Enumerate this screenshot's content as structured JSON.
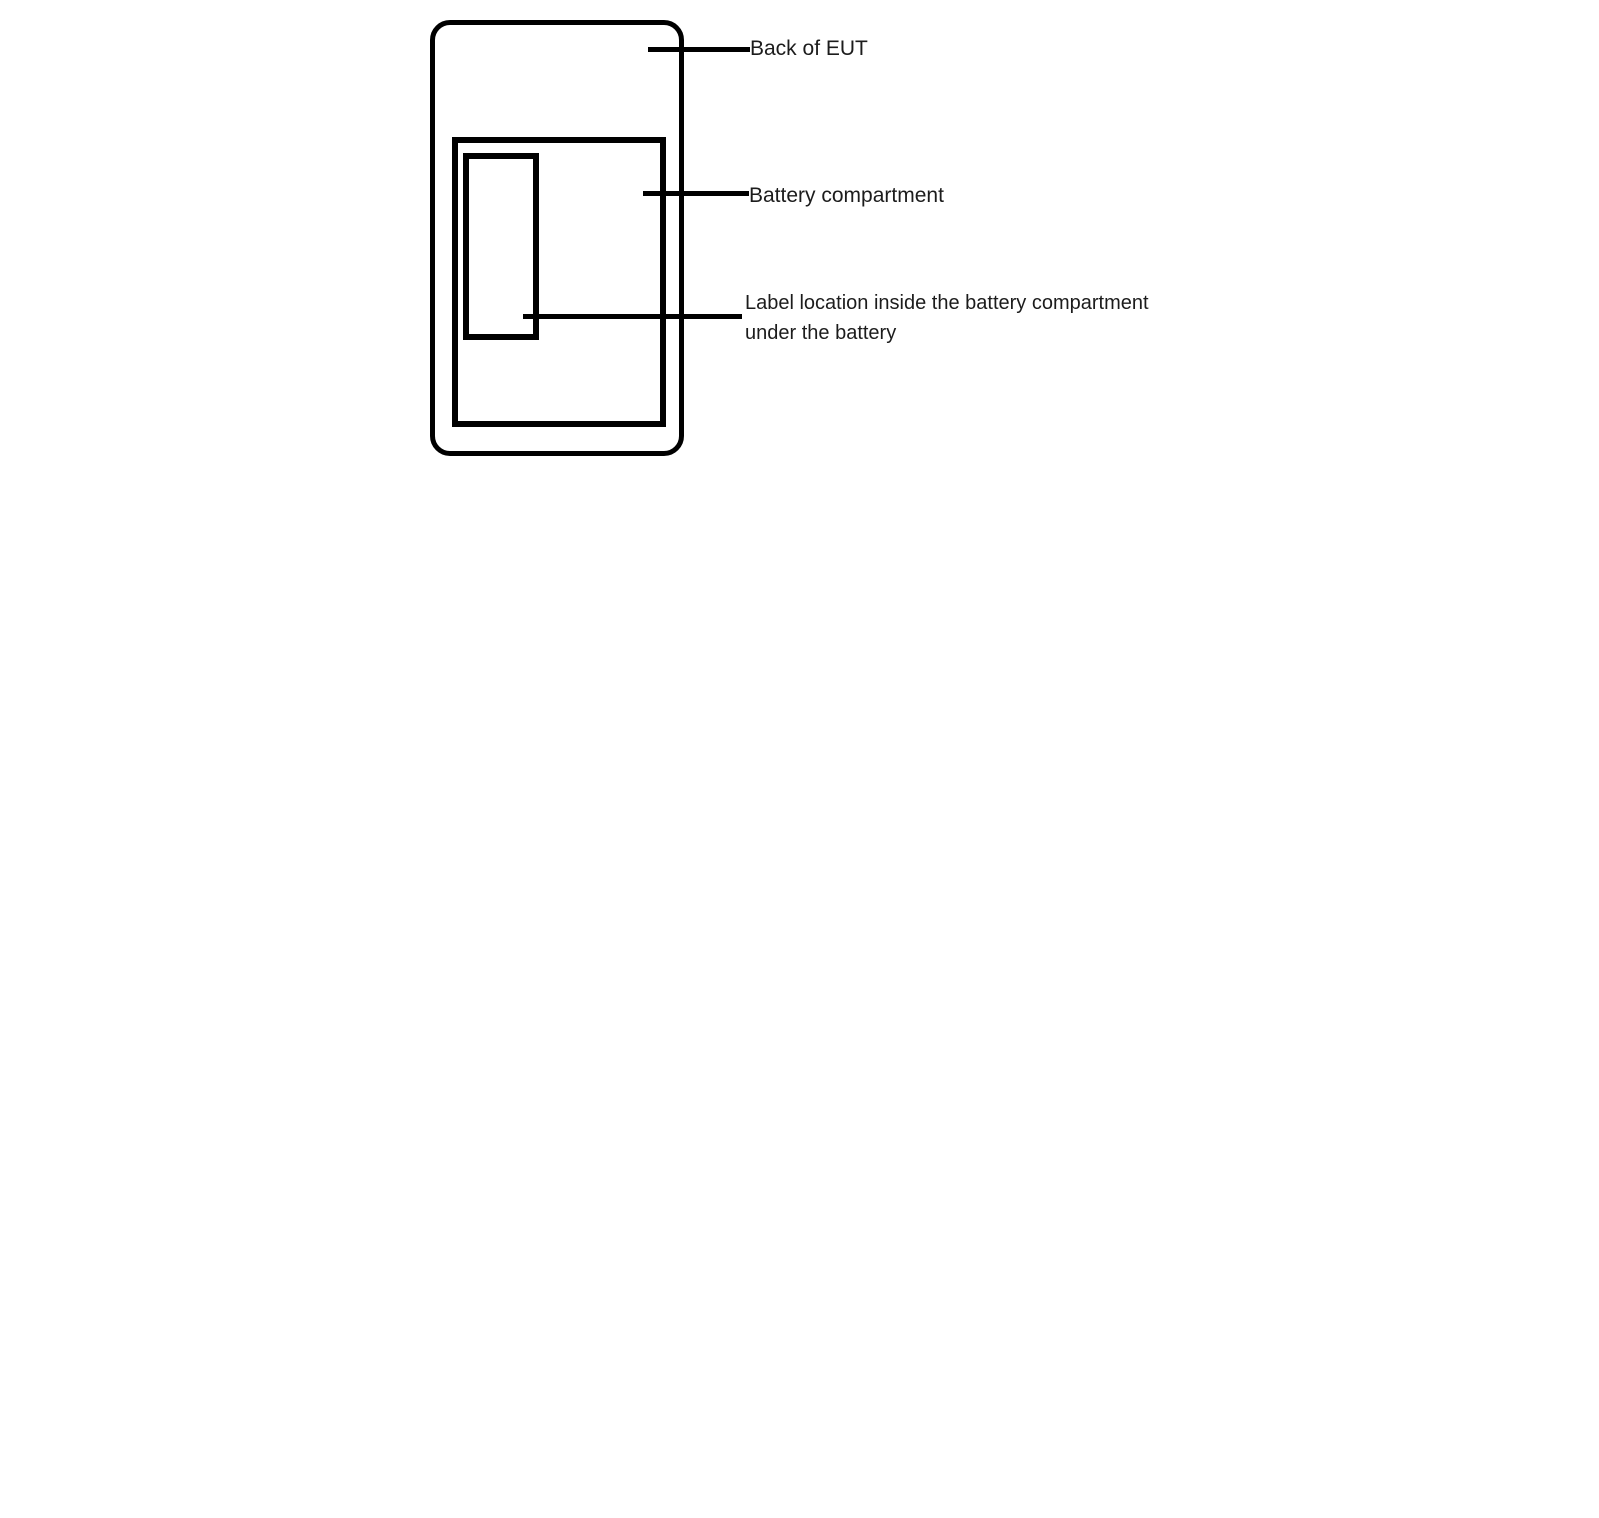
{
  "figure": {
    "description": "Label location diagram for back of EUT",
    "colors": {
      "line": "#000000",
      "text": "#1c1c1c",
      "background": "#ffffff"
    },
    "annotations": {
      "back_of_eut": "Back of EUT",
      "battery_compartment": "Battery compartment",
      "label_location_line1": "Label location inside the battery compartment",
      "label_location_line2": "under the battery"
    }
  }
}
